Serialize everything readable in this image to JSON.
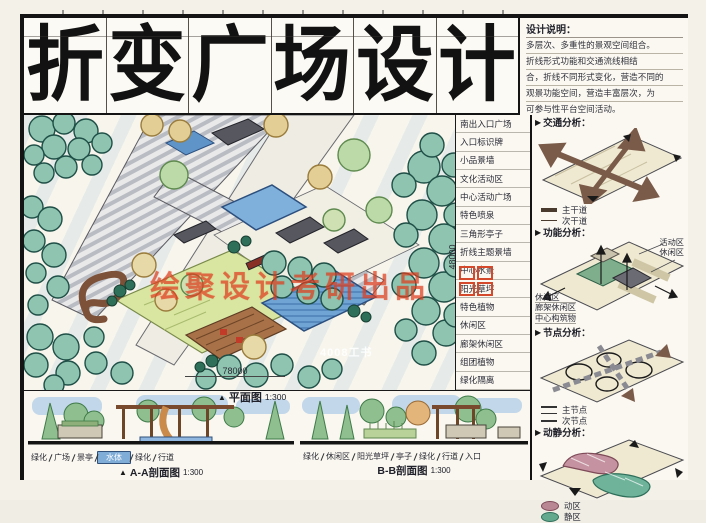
{
  "title": {
    "full": "折变广场设计",
    "chars": [
      "折",
      "变",
      "广",
      "场",
      "设",
      "计"
    ]
  },
  "icons": {
    "section_marker": "▶",
    "title_marker": "▲"
  },
  "design_notes": {
    "heading": "设计说明：",
    "lines": [
      "多层次、多重性的景观空间组合。",
      "折线形式功能和交通流线相结",
      "合，折线不同形式变化，营造不同的",
      "观景功能空间，营造丰富层次，为",
      "可参与性平台空间活动。"
    ]
  },
  "plan_labels": [
    "南出入口广场",
    "入口标识牌",
    "小品景墙",
    "文化活动区",
    "中心活动广场",
    "特色喷泉",
    "三角形亭子",
    "折线主题景墙",
    "中心水景",
    "阳光草坪",
    "特色植物",
    "休闲区",
    "廊架休闲区",
    "组团植物",
    "绿化隔离"
  ],
  "plan": {
    "watermark_red": "绘聚设计考研出品",
    "watermark_white": "4008工书",
    "dim_width": "78000",
    "dim_height": "48000",
    "title": "平面图",
    "scale": "1:300"
  },
  "analysis": {
    "traffic": {
      "heading": "交通分析：",
      "legend": [
        {
          "label": "主干道"
        },
        {
          "label": "次干道"
        }
      ]
    },
    "function": {
      "heading": "功能分析：",
      "right_labels": [
        "活动区",
        "休闲区"
      ],
      "left_labels": [
        "休闲区",
        "廊架休闲区",
        "中心构筑物"
      ]
    },
    "nodes": {
      "heading": "节点分析：",
      "legend": [
        {
          "label": "主节点"
        },
        {
          "label": "次节点"
        }
      ]
    },
    "dynamic": {
      "heading": "动静分析：",
      "legend": [
        {
          "label": "动区",
          "color": "#b98794"
        },
        {
          "label": "静区",
          "color": "#63a98e"
        }
      ]
    }
  },
  "sections": {
    "aa": {
      "title": "A-A剖面图",
      "scale": "1:300",
      "labels": [
        "绿化",
        "广场",
        "景亭",
        "水体",
        "绿化",
        "行道"
      ]
    },
    "bb": {
      "title": "B-B剖面图",
      "scale": "1:300",
      "labels": [
        "绿化",
        "休闲区",
        "阳光草坪",
        "亭子",
        "绿化",
        "行道",
        "入口"
      ]
    }
  },
  "palette": {
    "tree_teal": "#8ec4b0",
    "tree_dark": "#2e6f5a",
    "lawn": "#d8e6a2",
    "water": "#6fa4d4",
    "deck_brown": "#9a6b4a",
    "paper": "#f6f4ec",
    "ink": "#141414",
    "watermark_red": "#e03c28",
    "sky": "#bcd7ee"
  }
}
